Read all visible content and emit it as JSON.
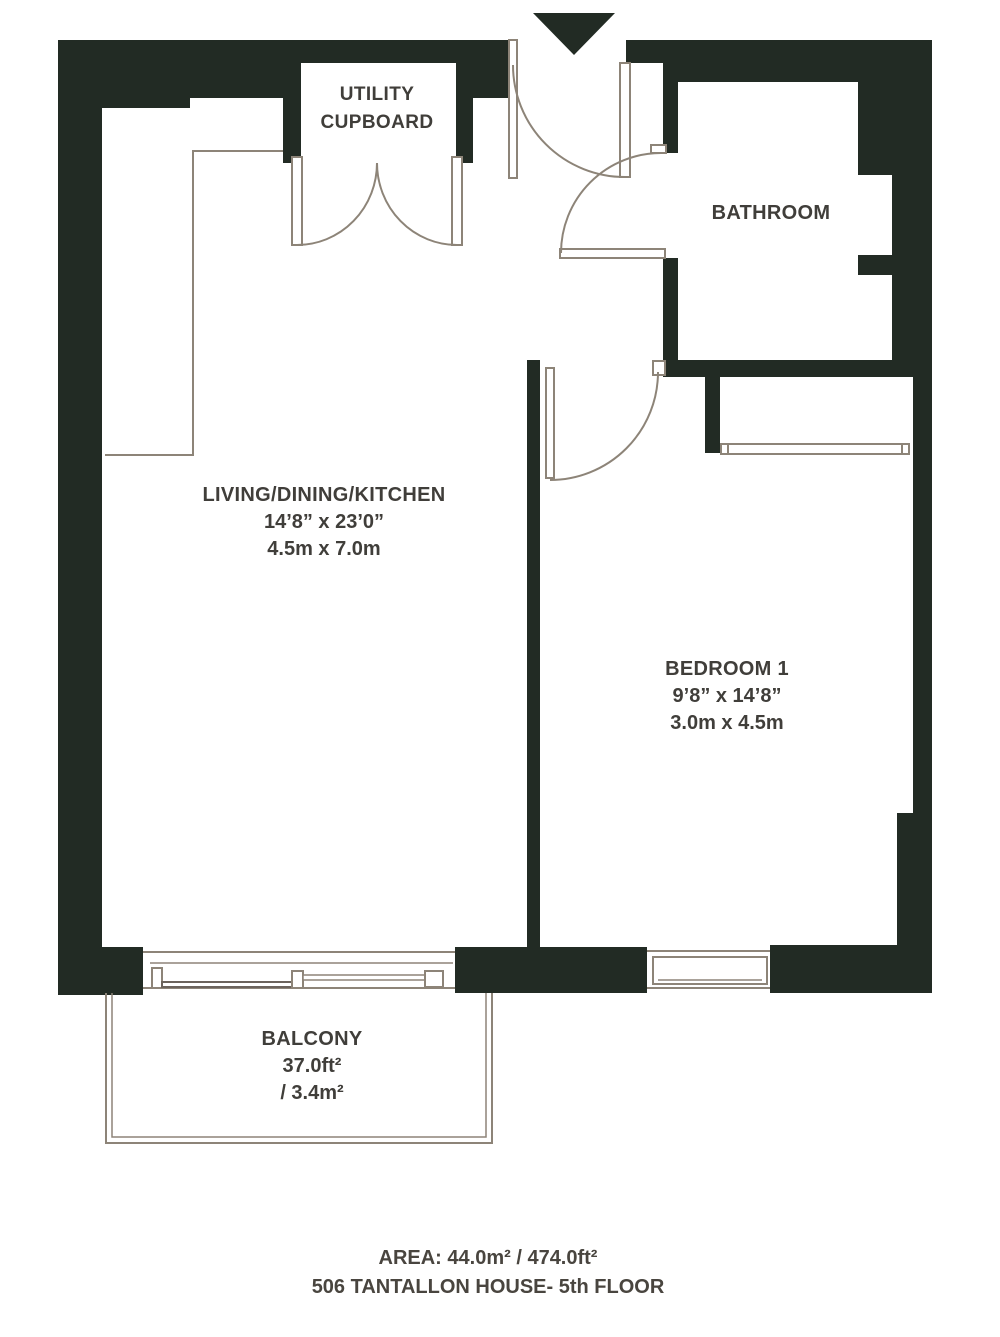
{
  "plan": {
    "title": "floor-plan",
    "colors": {
      "wall": "#222b24",
      "thin_line": "#8d8478",
      "text": "#403e3a",
      "background": "#ffffff"
    },
    "icons": {
      "entrance_arrow": "triangle-down"
    },
    "rooms": {
      "utility_cupboard": {
        "label_line1": "UTILITY",
        "label_line2": "CUPBOARD"
      },
      "bathroom": {
        "label": "BATHROOM"
      },
      "living": {
        "label": "LIVING/DINING/KITCHEN",
        "dims_imperial": "14’8” x 23’0”",
        "dims_metric": "4.5m x 7.0m"
      },
      "bedroom": {
        "label": "BEDROOM 1",
        "dims_imperial": "9’8” x 14’8”",
        "dims_metric": "3.0m x 4.5m"
      },
      "balcony": {
        "label": "BALCONY",
        "area_imperial": "37.0ft²",
        "area_metric": "/ 3.4m²"
      }
    },
    "footer": {
      "area": "AREA: 44.0m² / 474.0ft²",
      "address": "506 TANTALLON HOUSE- 5th FLOOR"
    }
  }
}
